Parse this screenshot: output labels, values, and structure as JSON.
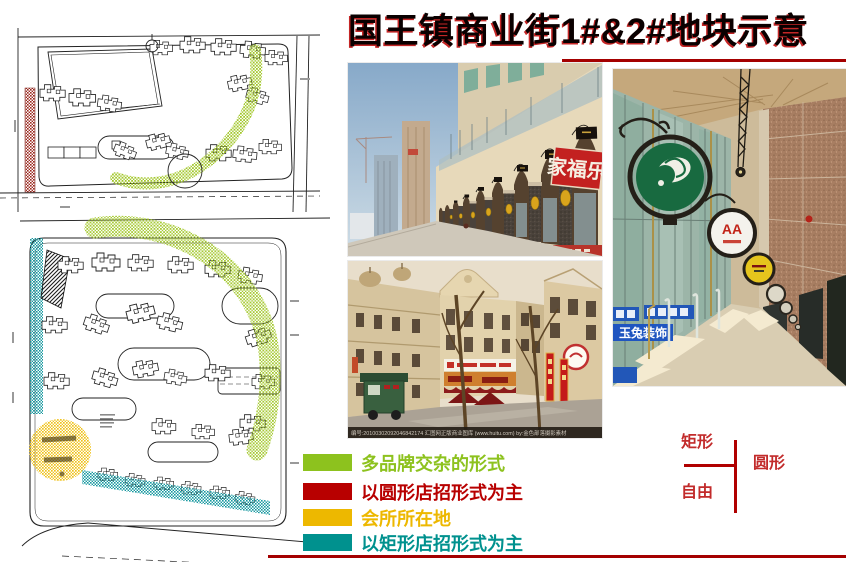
{
  "title": "国王镇商业街1#&2#地块示意",
  "colors": {
    "rule_red": "#A40000",
    "title_shadow_red": "#BA0000",
    "plan_green_highlight": "#9DC41F",
    "plan_red_hatch": "#9C2A20",
    "plan_yellow_highlight": "#EFC31F",
    "plan_teal_highlight": "#1898A0"
  },
  "legend": {
    "items": [
      {
        "label": "多品牌交杂的形式",
        "color": "#8DC21E"
      },
      {
        "label": "以圆形店招形式为主",
        "color": "#B80000"
      },
      {
        "label": "会所所在地",
        "color": "#EDB800"
      },
      {
        "label": "以矩形店招形式为主",
        "color": "#00918E"
      }
    ]
  },
  "shape_diagram": {
    "rect_label": "矩形",
    "circle_label": "圆形",
    "free_label": "自由"
  },
  "photos": {
    "arcade": {
      "red_sign": "家福乐"
    },
    "euro_street": {
      "watermark": "编号:20100302092046842174  汇图网正版商业图库 (www.huitu.com)  by:金色部落摄影素材"
    },
    "corridor": {
      "sign_aa": "AA",
      "sign_blue": "玉兔装饰"
    }
  }
}
